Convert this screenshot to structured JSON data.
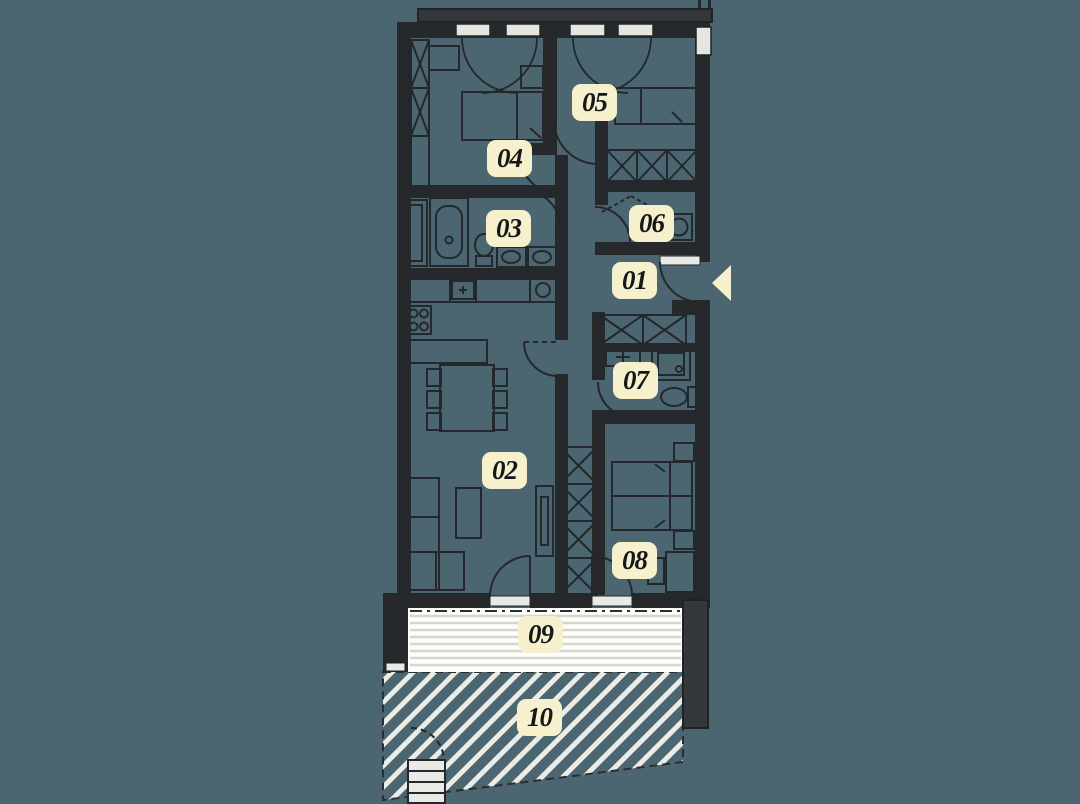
{
  "floor_plan": {
    "rooms": [
      {
        "id": "room-01",
        "label": "01"
      },
      {
        "id": "room-02",
        "label": "02"
      },
      {
        "id": "room-03",
        "label": "03"
      },
      {
        "id": "room-04",
        "label": "04"
      },
      {
        "id": "room-05",
        "label": "05"
      },
      {
        "id": "room-06",
        "label": "06"
      },
      {
        "id": "room-07",
        "label": "07"
      },
      {
        "id": "room-08",
        "label": "08"
      },
      {
        "id": "room-09",
        "label": "09"
      },
      {
        "id": "room-10",
        "label": "10"
      }
    ],
    "icons": {
      "entry_arrow": "left-pointing-triangle"
    },
    "colors": {
      "background": "#4B6670",
      "walls": "#26292B",
      "slab_fill": "#34383A",
      "label_background": "#F6F0CC",
      "label_text": "#15181B",
      "terrace_white": "#FDFDFB",
      "terrace_stripe": "#D6D6D1",
      "garden_hatch_stripe": "#ECECE7",
      "arrow": "#F6F0CC"
    },
    "patterns": {
      "terrace": "horizontal-stripes",
      "garden": "diagonal-hatch"
    }
  }
}
